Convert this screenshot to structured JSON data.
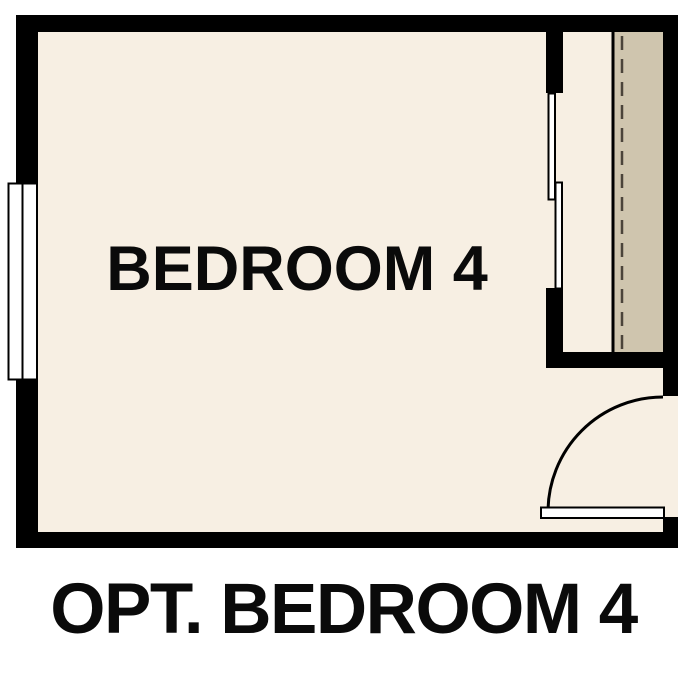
{
  "floorplan": {
    "room_label": "BEDROOM 4",
    "caption": "OPT. BEDROOM 4"
  },
  "colors": {
    "background": "#ffffff",
    "wall": "#000000",
    "floor": "#f7efe3",
    "closet_shelf": "#cfc5ae",
    "closet_rod": "#4b443a",
    "fixture_fill": "#ffffff",
    "text": "#0a0a0a"
  }
}
